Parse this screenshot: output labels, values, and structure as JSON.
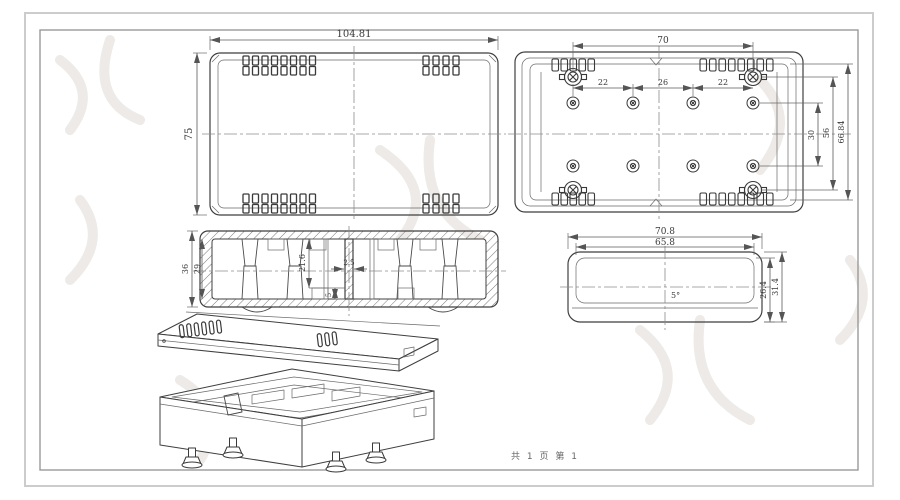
{
  "page": {
    "footer": "共 1 页  第 1"
  },
  "colors": {
    "background": "#ffffff",
    "line": "#3f3f3f",
    "dim_line": "#5a5a5a",
    "centerline": "#8c8c8c",
    "frame_outer": "#cccccc",
    "frame_inner": "#9a9a9a",
    "watermark": "#edeae7"
  },
  "views": {
    "top_view": {
      "dims": {
        "width": "104.81",
        "height": "75"
      }
    },
    "bottom_view": {
      "dims": {
        "boss_span": "70",
        "pitch_left": "22",
        "pitch_center": "26",
        "pitch_right": "22",
        "row_gap": "30",
        "corner_span": "56",
        "inner_height": "66.84"
      }
    },
    "section_view": {
      "dims": {
        "outer_height": "36",
        "inner_height": "29",
        "boss_height": "21.6",
        "rib": "2.5",
        "foot": "5"
      }
    },
    "end_view": {
      "dims": {
        "outer_width": "70.8",
        "inner_width": "65.8",
        "inner_height": "26.4",
        "outer_height": "31.4",
        "draft_angle": "5°"
      }
    }
  }
}
